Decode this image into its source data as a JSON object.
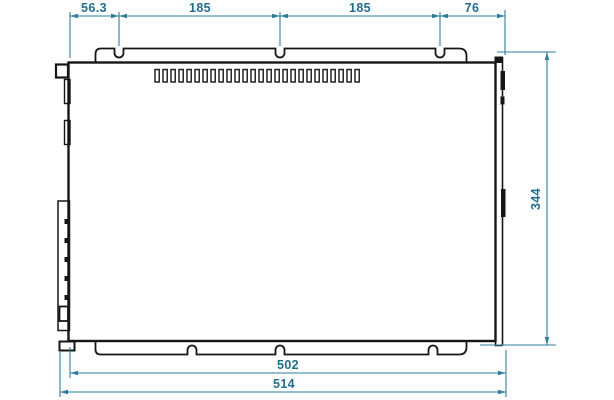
{
  "page": {
    "background": "#ffffff"
  },
  "drawing": {
    "kind": "technical-dimension-drawing",
    "outline_color": "#161616",
    "dimension_line_color": "#2e7d9b",
    "dimension_text_color": "#1f6e8e",
    "vent_slot_count": 26,
    "terminal_pin_count": 5,
    "dimensions": {
      "top_chain": [
        {
          "label": "56.3"
        },
        {
          "label": "185"
        },
        {
          "label": "185"
        },
        {
          "label": "76"
        }
      ],
      "right_height": {
        "label": "344"
      },
      "bottom_width_inner": {
        "label": "502"
      },
      "bottom_width_overall": {
        "label": "514"
      }
    }
  }
}
